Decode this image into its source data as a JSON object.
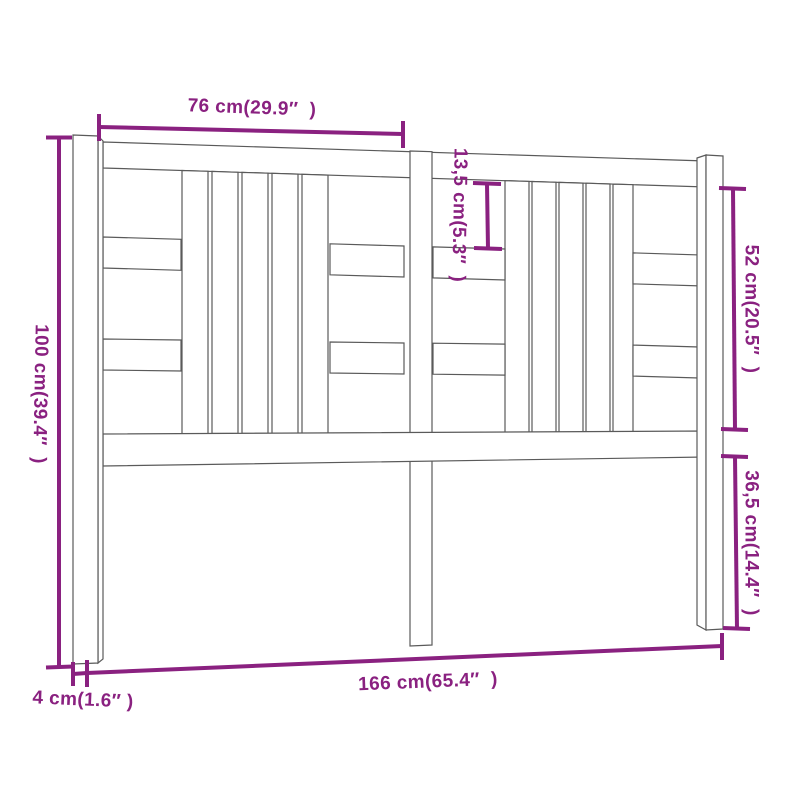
{
  "page": {
    "background": "#ffffff",
    "description": "Technical dimension drawing of a wooden bed headboard with three legs, top and bottom rails, vertical slat groups and horizontal side slats, drawn in light perspective"
  },
  "drawing": {
    "outline_color": "#5a5a5a",
    "dimension_color": "#8a2180"
  },
  "dimensions": {
    "top_width": {
      "label": "76 cm(29.9″  )",
      "value_cm": 76,
      "value_in": 29.9,
      "orientation": "horizontal"
    },
    "slat_gap": {
      "label": "13,5 cm(5.3″  )",
      "value_cm": 13.5,
      "value_in": 5.3,
      "orientation": "vertical"
    },
    "upper_side_height": {
      "label": "52 cm(20.5″  )",
      "value_cm": 52,
      "value_in": 20.5,
      "orientation": "vertical"
    },
    "total_height": {
      "label": "100 cm(39.4″  )",
      "value_cm": 100,
      "value_in": 39.4,
      "orientation": "vertical"
    },
    "lower_side_height": {
      "label": "36,5 cm(14.4″  )",
      "value_cm": 36.5,
      "value_in": 14.4,
      "orientation": "vertical"
    },
    "total_width": {
      "label": "166 cm(65.4″  )",
      "value_cm": 166,
      "value_in": 65.4,
      "orientation": "horizontal"
    },
    "leg_thickness": {
      "label": "4 cm(1.6″ )",
      "value_cm": 4,
      "value_in": 1.6,
      "orientation": "horizontal"
    }
  }
}
